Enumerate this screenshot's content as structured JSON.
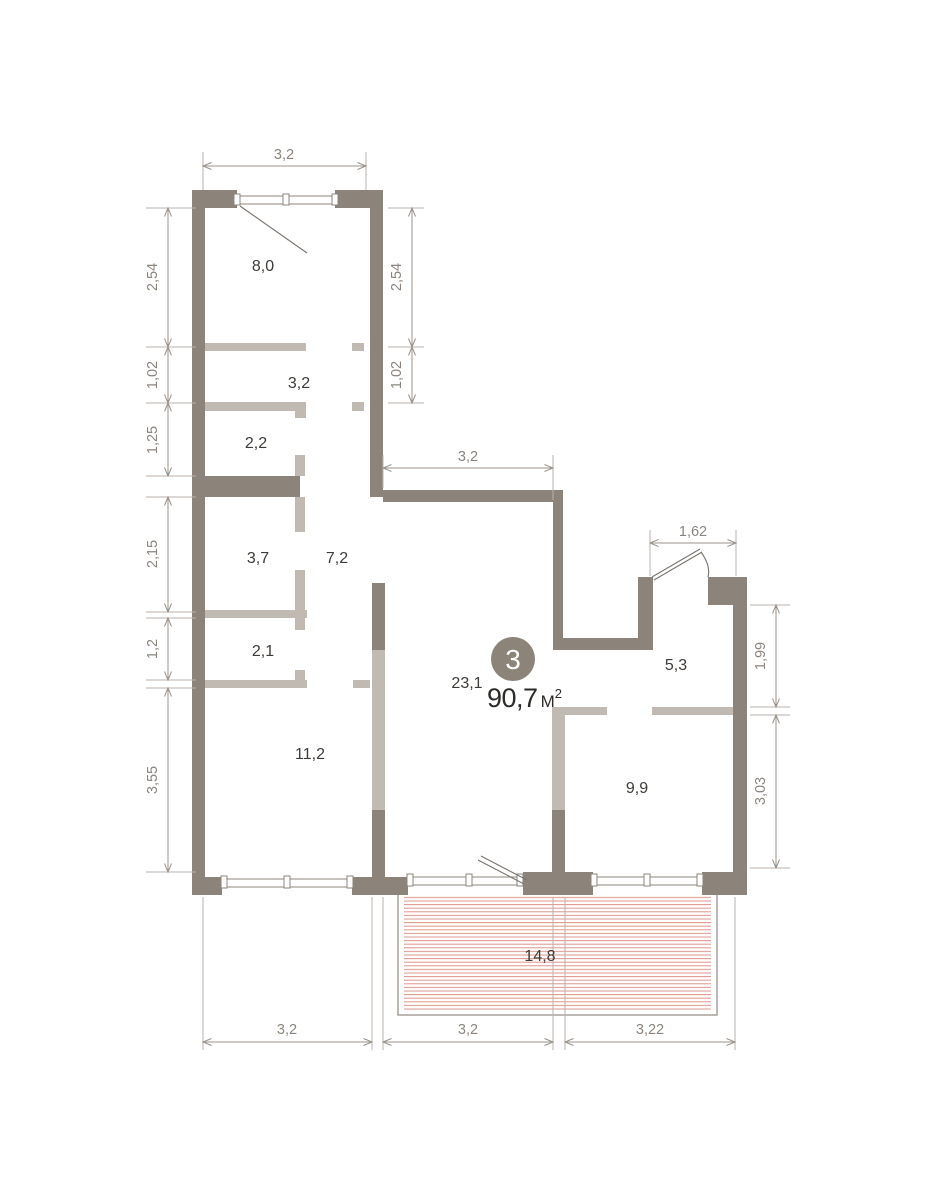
{
  "unit": {
    "number": "3",
    "area_value": "90,7",
    "area_unit": "М",
    "area_sup": "2"
  },
  "rooms": [
    {
      "id": "room-8-0",
      "label": "8,0"
    },
    {
      "id": "room-3-2",
      "label": "3,2"
    },
    {
      "id": "room-2-2",
      "label": "2,2"
    },
    {
      "id": "room-3-7",
      "label": "3,7"
    },
    {
      "id": "room-7-2",
      "label": "7,2"
    },
    {
      "id": "room-2-1",
      "label": "2,1"
    },
    {
      "id": "room-11-2",
      "label": "11,2"
    },
    {
      "id": "room-23-1",
      "label": "23,1"
    },
    {
      "id": "room-5-3",
      "label": "5,3"
    },
    {
      "id": "room-9-9",
      "label": "9,9"
    },
    {
      "id": "balcony-14-8",
      "label": "14,8"
    }
  ],
  "dimensions": {
    "top": "3,2",
    "left": [
      "2,54",
      "1,02",
      "1,25",
      "2,15",
      "1,2",
      "3,55"
    ],
    "inner_right": [
      "2,54",
      "1,02"
    ],
    "middle": "3,2",
    "entrance": "1,62",
    "right": [
      "1,99",
      "3,03"
    ],
    "bottom": [
      "3,2",
      "3,2",
      "3,22"
    ]
  },
  "colors": {
    "wall_dark": "#8c847b",
    "wall_light": "#c1bab3",
    "dimension_line": "#9a938c",
    "dimension_text": "#8b857e",
    "balcony_hatch": "#dd938a",
    "badge": "#8c8478",
    "room_label": "#3e3b38",
    "area_text": "#2d2b28"
  }
}
